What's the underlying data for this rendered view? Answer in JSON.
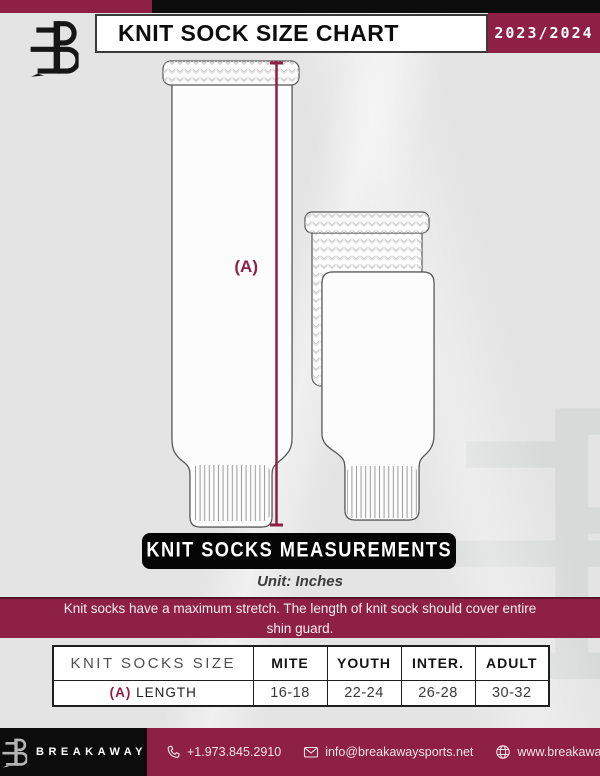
{
  "header": {
    "title": "KNIT SOCK SIZE CHART",
    "season": "2023/2024"
  },
  "illustration": {
    "measure_label": "(A)"
  },
  "measurements": {
    "banner": "KNIT SOCKS MEASUREMENTS",
    "unit": "Unit: Inches",
    "note": "Knit socks have a maximum stretch. The length of knit sock should cover entire shin guard."
  },
  "table": {
    "header": [
      "KNIT SOCKS SIZE",
      "MITE",
      "YOUTH",
      "INTER.",
      "ADULT"
    ],
    "row": {
      "prefix": "(A)",
      "label": "LENGTH",
      "values": [
        "16-18",
        "22-24",
        "26-28",
        "30-32"
      ]
    }
  },
  "footer": {
    "brand": "BREAKAWAY",
    "phone": "+1.973.845.2910",
    "email": "info@breakawaysports.net",
    "website": "www.breakawaysports.net"
  },
  "colors": {
    "accent_maroon": "#8e2045",
    "black": "#0d0d0d",
    "background": "#e3e4e3"
  }
}
